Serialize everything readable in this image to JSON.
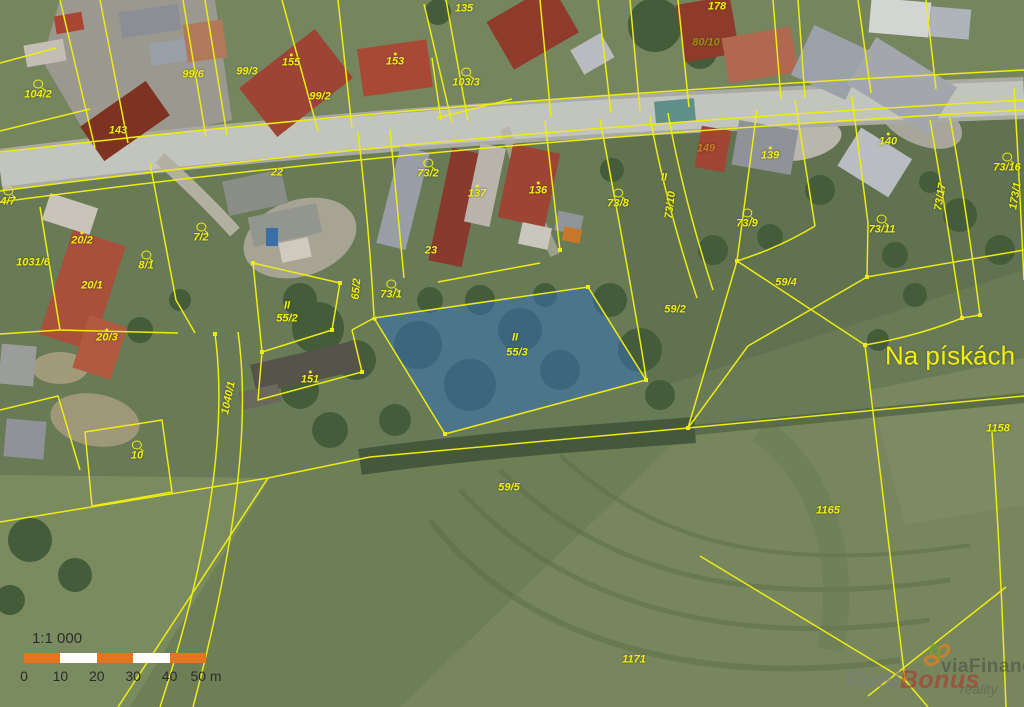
{
  "map": {
    "place_name": "Na pískách",
    "label_color": "#f0ee10",
    "boundary_color": "#ecec14",
    "highlight_fill": "#3470b6",
    "highlighted_parcel": "55/3",
    "parcel_labels": [
      {
        "text": "104/2",
        "x": 38,
        "y": 90,
        "symbol": "circle"
      },
      {
        "text": "143",
        "x": 118,
        "y": 131
      },
      {
        "text": "99/6",
        "x": 193,
        "y": 75
      },
      {
        "text": "99/3",
        "x": 247,
        "y": 72
      },
      {
        "text": "155",
        "x": 291,
        "y": 61,
        "symbol": "dot"
      },
      {
        "text": "99/2",
        "x": 320,
        "y": 97
      },
      {
        "text": "153",
        "x": 395,
        "y": 60,
        "symbol": "dot"
      },
      {
        "text": "103/3",
        "x": 466,
        "y": 78,
        "symbol": "circle"
      },
      {
        "text": "135",
        "x": 464,
        "y": 9
      },
      {
        "text": "178",
        "x": 717,
        "y": 7
      },
      {
        "text": "80/10",
        "x": 706,
        "y": 43,
        "color": "#a08c10"
      },
      {
        "text": "140",
        "x": 888,
        "y": 140,
        "symbol": "dot"
      },
      {
        "text": "73/16",
        "x": 1007,
        "y": 163,
        "symbol": "circle"
      },
      {
        "text": "173/1",
        "x": 1016,
        "y": 196,
        "rotation": -80
      },
      {
        "text": "73/2",
        "x": 428,
        "y": 169,
        "symbol": "circle"
      },
      {
        "text": "137",
        "x": 477,
        "y": 192,
        "symbol": "dot"
      },
      {
        "text": "136",
        "x": 538,
        "y": 189,
        "symbol": "dot"
      },
      {
        "text": "73/8",
        "x": 618,
        "y": 199,
        "symbol": "circle"
      },
      {
        "text": "II",
        "x": 664,
        "y": 178
      },
      {
        "text": "73/10",
        "x": 671,
        "y": 205,
        "rotation": -83
      },
      {
        "text": "149",
        "x": 706,
        "y": 149,
        "color": "#cc7a22"
      },
      {
        "text": "139",
        "x": 770,
        "y": 154,
        "symbol": "dot"
      },
      {
        "text": "73/9",
        "x": 747,
        "y": 219,
        "symbol": "circle"
      },
      {
        "text": "73/11",
        "x": 882,
        "y": 225,
        "symbol": "circle"
      },
      {
        "text": "73/17",
        "x": 941,
        "y": 197,
        "rotation": -80
      },
      {
        "text": "22",
        "x": 277,
        "y": 173
      },
      {
        "text": "23",
        "x": 431,
        "y": 251
      },
      {
        "text": "4/7",
        "x": 8,
        "y": 197,
        "symbol": "circle"
      },
      {
        "text": "1031/6",
        "x": 33,
        "y": 263
      },
      {
        "text": "20/2",
        "x": 82,
        "y": 239,
        "symbol": "dot"
      },
      {
        "text": "20/1",
        "x": 92,
        "y": 286
      },
      {
        "text": "20/3",
        "x": 107,
        "y": 336,
        "symbol": "dot"
      },
      {
        "text": "8/1",
        "x": 146,
        "y": 261,
        "symbol": "circle"
      },
      {
        "text": "7/2",
        "x": 201,
        "y": 233,
        "symbol": "circle"
      },
      {
        "text": "65/2",
        "x": 357,
        "y": 289,
        "rotation": -85
      },
      {
        "text": "II",
        "x": 287,
        "y": 306
      },
      {
        "text": "55/2",
        "x": 287,
        "y": 319
      },
      {
        "text": "73/1",
        "x": 391,
        "y": 290,
        "symbol": "circle"
      },
      {
        "text": "151",
        "x": 310,
        "y": 378,
        "symbol": "dot"
      },
      {
        "text": "1040/1",
        "x": 229,
        "y": 398,
        "rotation": -78
      },
      {
        "text": "10",
        "x": 137,
        "y": 451,
        "symbol": "circle"
      },
      {
        "text": "II",
        "x": 515,
        "y": 338
      },
      {
        "text": "55/3",
        "x": 517,
        "y": 353
      },
      {
        "text": "59/2",
        "x": 675,
        "y": 310
      },
      {
        "text": "59/4",
        "x": 786,
        "y": 283
      },
      {
        "text": "59/5",
        "x": 509,
        "y": 488
      },
      {
        "text": "1165",
        "x": 828,
        "y": 511
      },
      {
        "text": "1171",
        "x": 634,
        "y": 660
      },
      {
        "text": "1158",
        "x": 998,
        "y": 429
      }
    ]
  },
  "scale_bar": {
    "ratio": "1:1 000",
    "tick_labels": [
      "0",
      "10",
      "20",
      "30",
      "40",
      "50 m"
    ],
    "segment_colors": [
      "#e2751d",
      "#ffffff",
      "#e2751d",
      "#ffffff",
      "#e2751d"
    ]
  },
  "watermark": {
    "company": "viaFinance",
    "company_sub": "reality",
    "brand_part1": "Real",
    "brand_part2": "Bonus"
  }
}
